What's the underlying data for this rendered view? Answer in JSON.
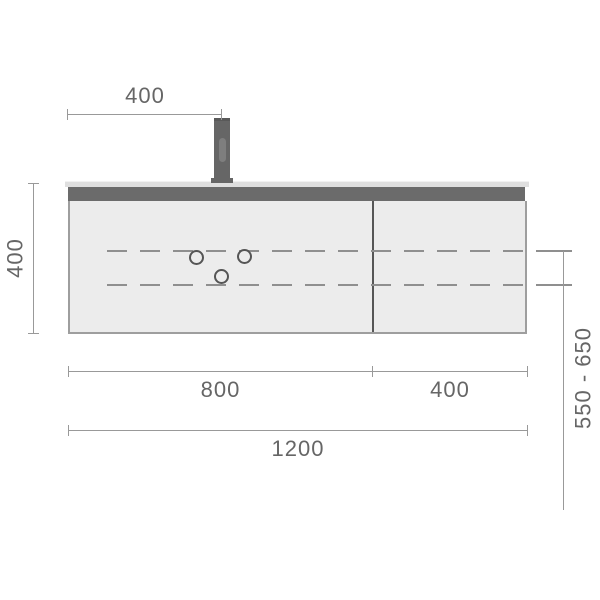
{
  "drawing": {
    "type": "technical-dimension-drawing",
    "features": {
      "service_holes": 3,
      "dashed_service_lines": 2,
      "sections": 2
    }
  },
  "dimensions": {
    "faucet_offset": "400",
    "cabinet_height": "400",
    "left_section_width": "800",
    "right_section_width": "400",
    "total_width": "1200",
    "mounting_height_range": "550 - 650"
  },
  "colors": {
    "dimension_line": "#999999",
    "dimension_text": "#666666",
    "cabinet_fill": "#ececec",
    "cabinet_border": "#9e9e9e",
    "countertop_bar": "#6b6b6b",
    "countertop_top": "#dfdfdf",
    "faucet": "#666666",
    "dashed_line": "#8f8f8f",
    "divider": "#565656",
    "hole_stroke": "#555555"
  }
}
